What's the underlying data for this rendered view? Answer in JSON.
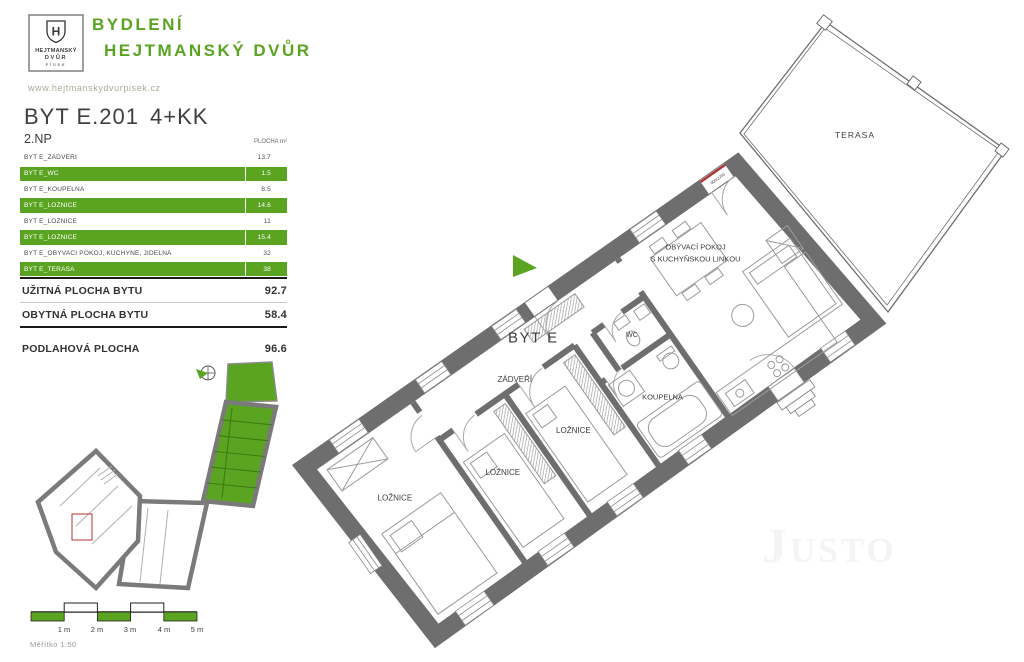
{
  "brand": {
    "logo_initial": "H",
    "logo_name_1": "HEJTMANSKÝ",
    "logo_name_2": "DVŮR",
    "logo_city": "PÍSEK",
    "title_line1": "BYDLENÍ",
    "title_line2": "HEJTMANSKÝ DVŮR",
    "website": "www.hejtmanskydvurpisek.cz"
  },
  "unit": {
    "code": "BYT E.201",
    "disposition": "4+KK",
    "floor": "2.NP",
    "area_col": "PLOCHA m²"
  },
  "areas": {
    "rows": [
      {
        "label": "BYT E_ZÁDVEŘÍ",
        "value": "13.7",
        "highlight": false
      },
      {
        "label": "BYT E_WC",
        "value": "1.5",
        "highlight": true
      },
      {
        "label": "BYT E_KOUPELNA",
        "value": "8.5",
        "highlight": false
      },
      {
        "label": "BYT E_LOŽNICE",
        "value": "14.6",
        "highlight": true
      },
      {
        "label": "BYT E_LOŽNICE",
        "value": "11",
        "highlight": false
      },
      {
        "label": "BYT E_LOŽNICE",
        "value": "15.4",
        "highlight": true
      },
      {
        "label": "BYT E_OBÝVACÍ POKOJ, KUCHYNĚ, JÍDELNA",
        "value": "32",
        "highlight": false
      },
      {
        "label": "BYT E_TERASA",
        "value": "38",
        "highlight": true
      }
    ],
    "totals": [
      {
        "label": "UŽITNÁ PLOCHA BYTU",
        "value": "92.7"
      },
      {
        "label": "OBYTNÁ PLOCHA BYTU",
        "value": "58.4"
      },
      {
        "label": "PODLAHOVÁ PLOCHA",
        "value": "96.6"
      }
    ]
  },
  "plan": {
    "unit_label": "BYT E",
    "rooms": {
      "zadveri": "ZÁDVEŘÍ",
      "wc": "WC",
      "koupelna": "KOUPELNA",
      "loznice": "LOŽNICE",
      "obyvaci_1": "OBÝVACÍ POKOJ",
      "obyvaci_2": "S KUCHYŇSKOU LINKOU",
      "terasa": "TERASA"
    },
    "door_dimension": "800/2250"
  },
  "scale": {
    "labels": [
      "1 m",
      "2 m",
      "3 m",
      "4 m",
      "5 m"
    ],
    "caption": "Měřítko 1:50"
  },
  "watermark": "Justo",
  "colors": {
    "green": "#5aa422",
    "wall_gray": "#6f6e6e"
  }
}
